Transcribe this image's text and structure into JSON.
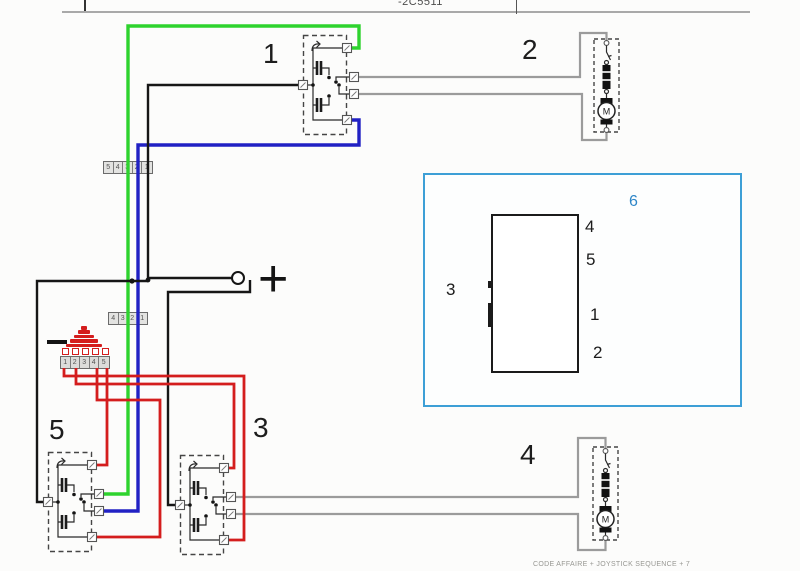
{
  "header": {
    "code": "-2C5511"
  },
  "component_labels": {
    "relay1": "1",
    "motor2": "2",
    "relay3": "3",
    "motor4": "4",
    "relay5": "5"
  },
  "battery": {
    "plus_label": "+"
  },
  "motor_glyph": "M",
  "connectors": {
    "c1_cells": [
      "5",
      "4",
      "3",
      "2",
      "1"
    ],
    "c2_cells": [
      "4",
      "3",
      "2",
      "1"
    ],
    "fuse_cells": [
      "1",
      "2",
      "3",
      "4",
      "5"
    ]
  },
  "inset_panel": {
    "connector6": "6",
    "pin4": "4",
    "pin5": "5",
    "pin3": "3",
    "pin1": "1",
    "pin2": "2"
  },
  "footer": {
    "caption": "CODE AFFAIRE + JOYSTICK SEQUENCE + 7"
  },
  "colors": {
    "green": "#2ed32e",
    "blue": "#2121c4",
    "red": "#d41d1d",
    "black": "#161616",
    "gray_wire": "#9b9b9b",
    "inset_blue": "#3d9fd6",
    "inset_text_blue": "#2e86c8"
  }
}
